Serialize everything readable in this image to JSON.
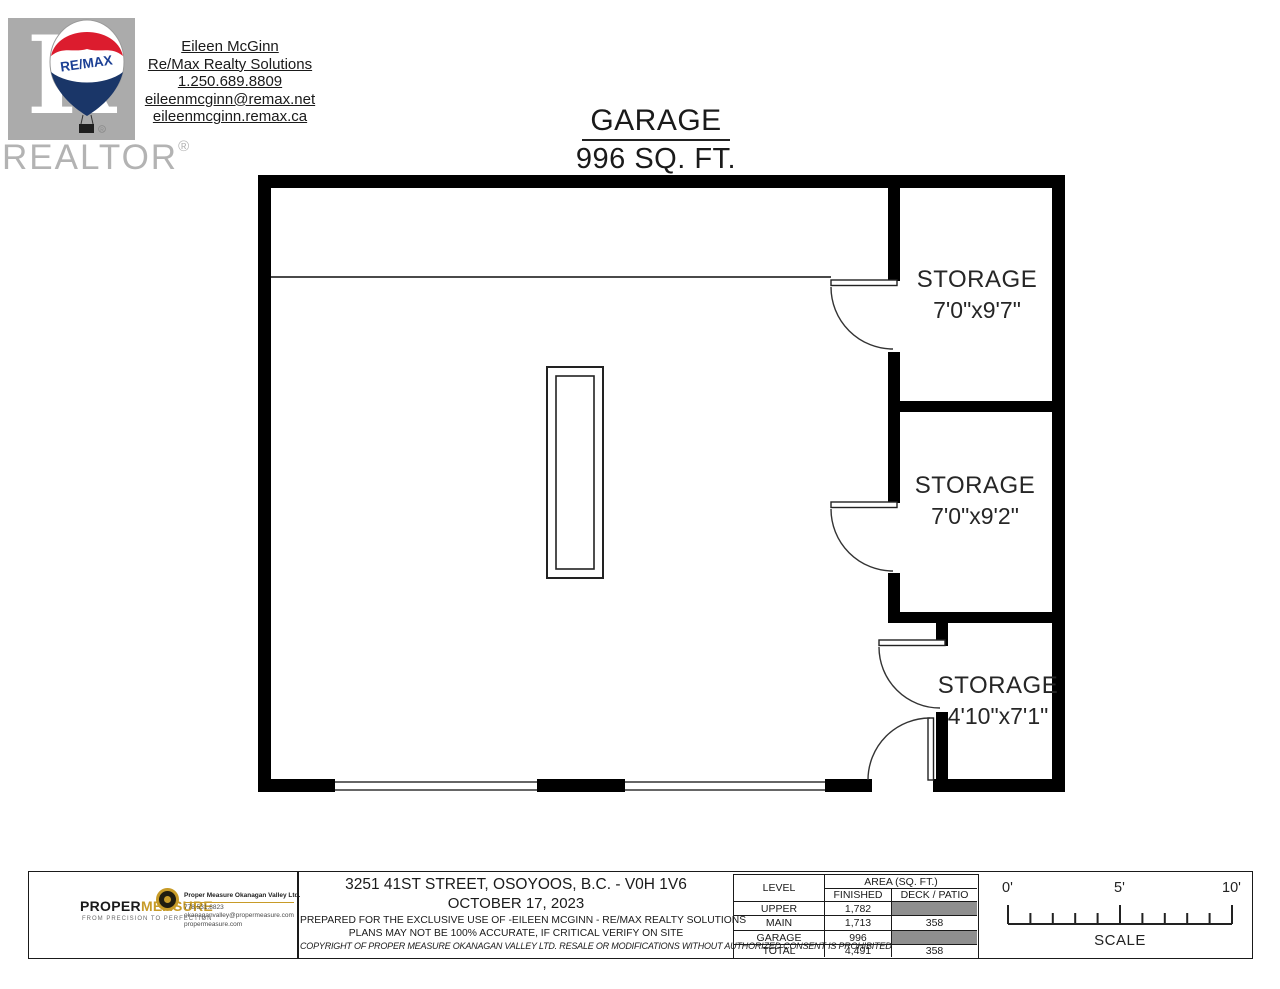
{
  "header": {
    "realtor_watermark": {
      "letter": "R",
      "label": "REALTOR",
      "reg": "®"
    },
    "remax_balloon": {
      "label": "RE/MAX",
      "red": "#dc1c2e",
      "blue": "#1a3668"
    },
    "agent": {
      "lines": [
        "Eileen McGinn",
        "Re/Max Realty Solutions",
        "1.250.689.8809",
        "eileenmcginn@remax.net",
        "eileenmcginn.remax.ca"
      ]
    }
  },
  "title": {
    "name": "GARAGE",
    "area": "996 SQ. FT."
  },
  "floorplan": {
    "rooms": [
      {
        "name": "STORAGE",
        "dims": "7'0\"x9'7\""
      },
      {
        "name": "STORAGE",
        "dims": "7'0\"x9'2\""
      },
      {
        "name": "STORAGE",
        "dims": "4'10\"x7'1\""
      }
    ]
  },
  "footer": {
    "propermeasure": {
      "brand_black": "PROPER",
      "brand_gold": "MEASURE",
      "tagline": "FROM PRECISION TO PERFECTION",
      "company": "Proper Measure Okanagan Valley Ltd.",
      "phone": "778.531.8823",
      "email": "okanaganvalley@propermeasure.com",
      "website": "propermeasure.com",
      "gold": "#c79b28"
    },
    "center": {
      "address": "3251 41ST STREET, OSOYOOS, B.C. - V0H 1V6",
      "date": "OCTOBER 17, 2023",
      "prepared": "PREPARED FOR THE EXCLUSIVE USE OF -EILEEN MCGINN - RE/MAX REALTY SOLUTIONS",
      "accuracy": "PLANS MAY NOT BE 100% ACCURATE, IF CRITICAL VERIFY ON SITE",
      "copyright": "COPYRIGHT OF PROPER MEASURE OKANAGAN VALLEY LTD. RESALE OR MODIFICATIONS WITHOUT AUTHORIZED CONSENT IS PROHIBITED"
    },
    "table": {
      "col_level": "LEVEL",
      "col_area": "AREA (SQ. FT.)",
      "col_finished": "FINISHED",
      "col_deck": "DECK / PATIO",
      "gray_color": "#8f8f8f",
      "rows": [
        {
          "level": "UPPER",
          "finished": "1,782",
          "deck": ""
        },
        {
          "level": "MAIN",
          "finished": "1,713",
          "deck": "358"
        },
        {
          "level": "GARAGE",
          "finished": "996",
          "deck": ""
        },
        {
          "level": "TOTAL",
          "finished": "4,491",
          "deck": "358"
        }
      ]
    },
    "scale": {
      "tick0": "0'",
      "tick5": "5'",
      "tick10": "10'",
      "label": "SCALE"
    }
  }
}
